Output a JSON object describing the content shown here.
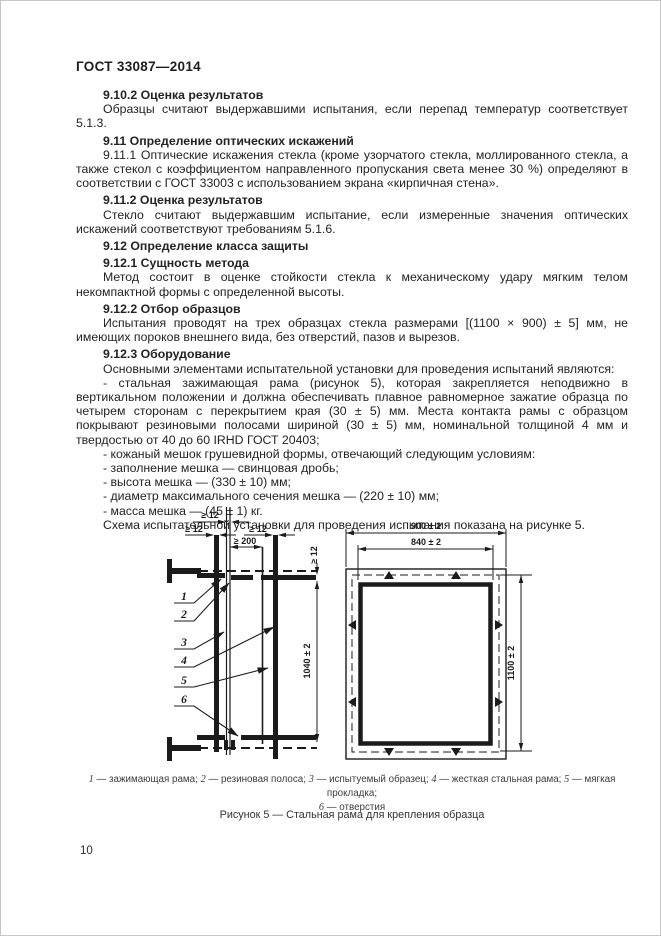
{
  "page": {
    "header": "ГОСТ 33087—2014",
    "page_number": "10"
  },
  "body": {
    "blocks": [
      {
        "type": "heading",
        "text": "9.10.2 Оценка результатов"
      },
      {
        "type": "para",
        "text": "Образцы считают выдержавшими испытания, если перепад температур соответствует 5.1.3."
      },
      {
        "type": "heading",
        "text": "9.11 Определение оптических искажений"
      },
      {
        "type": "para",
        "text": "9.11.1 Оптические искажения стекла (кроме узорчатого стекла, моллированного стекла, а также стекол с коэффициентом направленного пропускания света менее 30 %) определяют в соответствии с ГОСТ 33003 с использованием экрана «кирпичная стена»."
      },
      {
        "type": "heading",
        "text": "9.11.2 Оценка результатов"
      },
      {
        "type": "para",
        "text": "Стекло считают выдержавшим испытание, если измеренные значения оптических искажений соответствуют требованиям 5.1.6."
      },
      {
        "type": "heading",
        "text": "9.12 Определение класса защиты"
      },
      {
        "type": "heading",
        "text": "9.12.1 Сущность метода"
      },
      {
        "type": "para",
        "text": "Метод состоит в оценке стойкости стекла к механическому удару мягким телом некомпактной формы с определенной высоты."
      },
      {
        "type": "heading",
        "text": "9.12.2 Отбор образцов"
      },
      {
        "type": "para",
        "text": "Испытания проводят на трех образцах стекла размерами [(1100 × 900) ± 5] мм, не имеющих пороков внешнего вида, без отверстий, пазов и вырезов."
      },
      {
        "type": "heading",
        "text": "9.12.3 Оборудование"
      },
      {
        "type": "para",
        "text": "Основными элементами испытательной установки для проведения испытаний являются:"
      },
      {
        "type": "para",
        "text": "- стальная зажимающая рама (рисунок 5), которая закрепляется неподвижно в вертикальном положении и должна обеспечивать плавное равномерное зажатие образца по четырем сторонам с перекрытием края (30 ± 5) мм. Места контакта рамы с образцом покрывают резиновыми полосами шириной (30 ± 5) мм, номинальной толщиной 4 мм и твердостью от 40 до 60 IRHD ГОСТ 20403;"
      },
      {
        "type": "para",
        "text": "- кожаный мешок грушевидной формы, отвечающий следующим условиям:"
      },
      {
        "type": "para",
        "text": "- заполнение мешка — свинцовая дробь;"
      },
      {
        "type": "para",
        "text": "- высота мешка — (330 ± 10) мм;"
      },
      {
        "type": "para",
        "text": "- диаметр максимального сечения мешка — (220 ± 10) мм;"
      },
      {
        "type": "para",
        "text": "- масса мешка — (45 ± 1) кг."
      },
      {
        "type": "para",
        "text": "Схема испытательной установки для проведения испытания показана на рисунке 5."
      }
    ]
  },
  "figure": {
    "dims": {
      "ge12": "≥ 12",
      "ge200": "≥ 200",
      "h1040": "1040 ± 2",
      "w900": "900 ± 2",
      "w840": "840 ± 2",
      "h1100": "1100 ± 2"
    },
    "callouts": [
      "1",
      "2",
      "3",
      "4",
      "5",
      "6"
    ],
    "legend_lines": [
      [
        {
          "n": "1",
          "t": "зажимающая рама"
        },
        {
          "n": "2",
          "t": "резиновая полоса"
        },
        {
          "n": "3",
          "t": "испытуемый образец"
        },
        {
          "n": "4",
          "t": "жесткая стальная рама"
        },
        {
          "n": "5",
          "t": "мягкая прокладка"
        }
      ],
      [
        {
          "n": "6",
          "t": "отверстия"
        }
      ]
    ],
    "caption": "Рисунок 5 — Стальная рама для крепления образца"
  },
  "colors": {
    "ink": "#1b1b1b",
    "paper": "#ffffff"
  }
}
